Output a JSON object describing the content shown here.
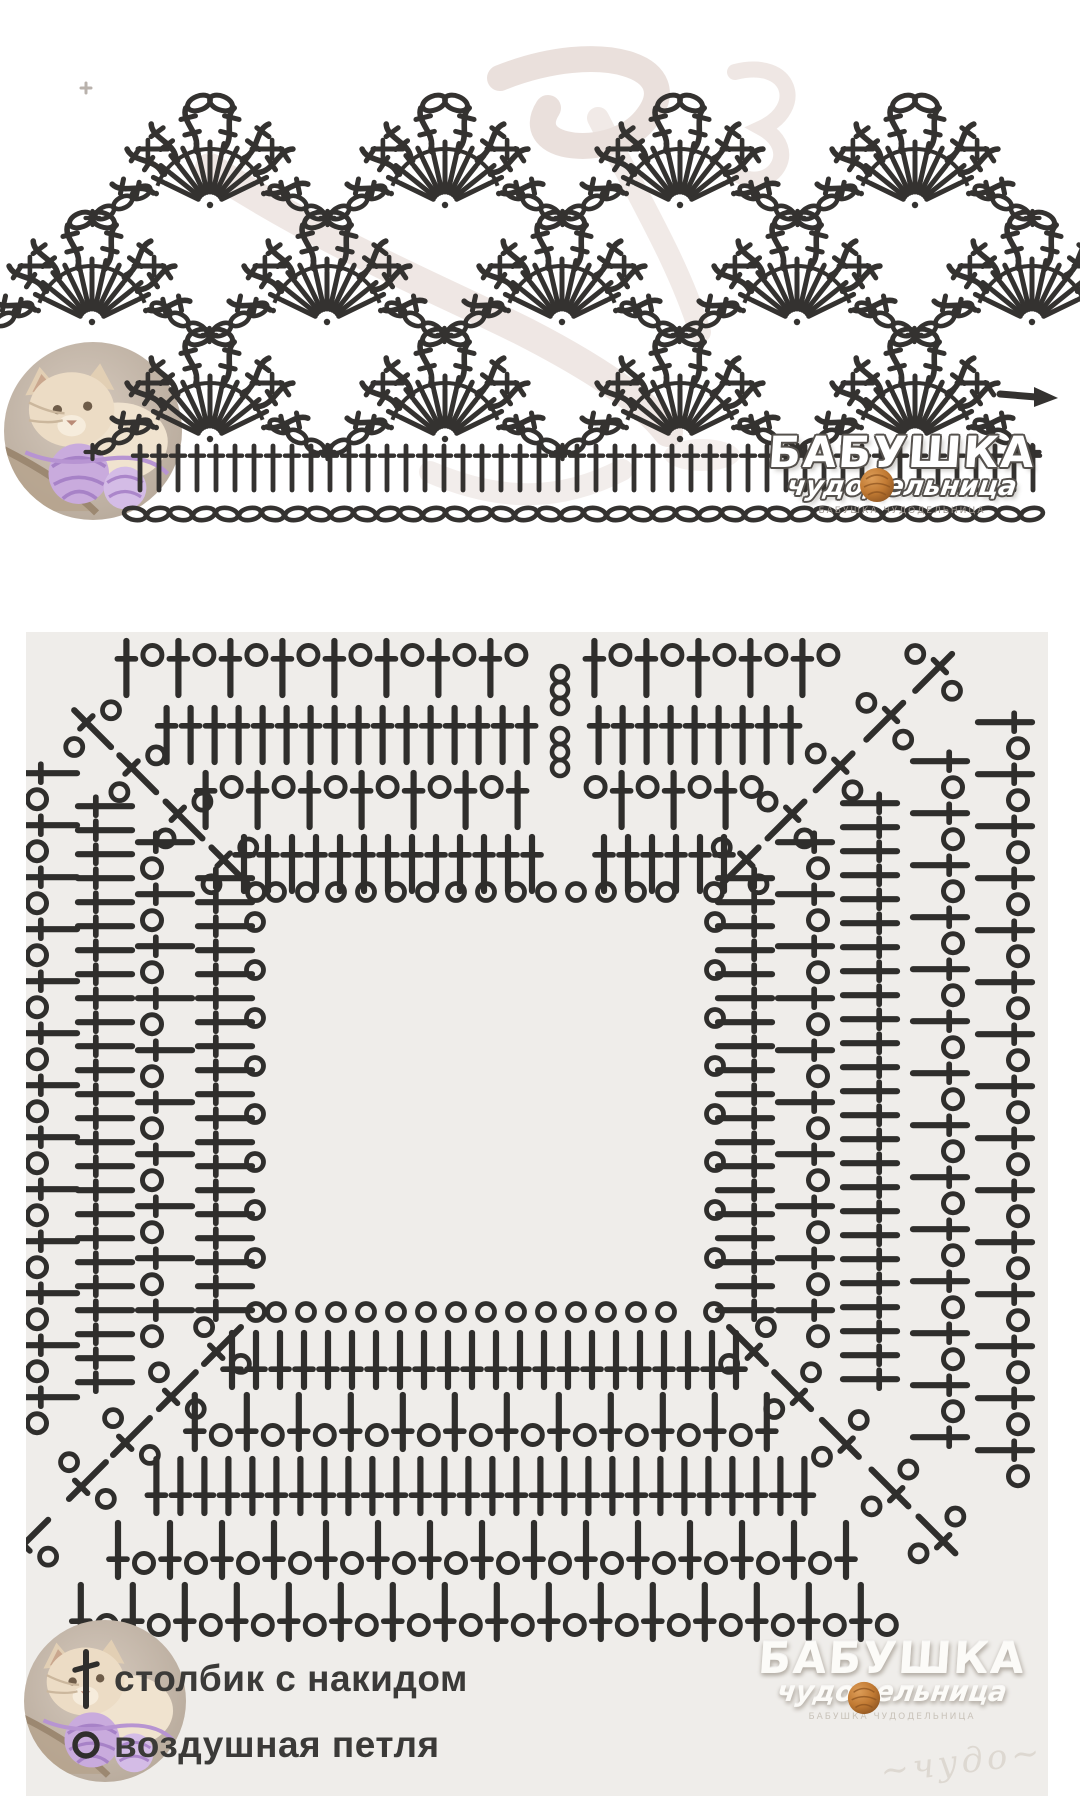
{
  "colors": {
    "page_bg": "#ffffff",
    "panel_bg": "#efedea",
    "symbol": "#2f2e2c",
    "symbol_top": "#343230",
    "watermark_pink": "#d9c8c1",
    "logo_outline": "#55514d",
    "logo_fill": "#ffffff",
    "yarn_ball": "#c17a33",
    "legend_text": "#3b3a38"
  },
  "branding": {
    "logo_line1": "БАБУШКА",
    "logo_line2": "чудодельница",
    "logo_caption": "БАБУШКА ЧУДОДЕЛЬНИЦА"
  },
  "legend": {
    "items": [
      {
        "symbol": "double-crochet-icon",
        "label": "столбик с накидом"
      },
      {
        "symbol": "chain-stitch-icon",
        "label": "воздушная петля"
      }
    ]
  },
  "top_diagram": {
    "rows": [
      {
        "base_y": 205,
        "fan_x": [
          210,
          445,
          680,
          915
        ]
      },
      {
        "base_y": 322,
        "fan_x": [
          92,
          327,
          562,
          797,
          1032
        ]
      },
      {
        "base_y": 439,
        "fan_x": [
          210,
          445,
          680,
          915
        ]
      }
    ],
    "fan": {
      "radius": 55,
      "spokes": 11
    },
    "cluster": {
      "arm_angles": [
        -78,
        -56,
        -36,
        -14,
        14,
        36,
        56,
        78
      ],
      "inner_r": 58,
      "outer_r": 100
    },
    "foundation": {
      "post_y": 468,
      "post_len": 44,
      "x_start": 140,
      "x_end": 1046,
      "post_step": 19,
      "chain_y": 514,
      "chain_step": 23
    },
    "turn_arrow": {
      "x": 1000,
      "y": 394
    }
  },
  "square_chart": {
    "hole": {
      "x1": 242,
      "y1": 272,
      "x2": 676,
      "y2": 668
    },
    "inner_ring": {
      "top_step": 30,
      "side_step": 48
    },
    "bands": {
      "top": {
        "rounds": [
          {
            "off": 40,
            "type": "cont"
          },
          {
            "off": 104,
            "type": "alt"
          },
          {
            "off": 169,
            "type": "cont"
          },
          {
            "off": 236,
            "type": "alt"
          }
        ]
      },
      "left": {
        "rounds": [
          {
            "off": 43,
            "type": "cont"
          },
          {
            "off": 103,
            "type": "alt"
          },
          {
            "off": 163,
            "type": "cont"
          },
          {
            "off": 218,
            "type": "alt"
          }
        ]
      },
      "right": {
        "rounds": [
          {
            "off": 43,
            "type": "cont"
          },
          {
            "off": 103,
            "type": "alt"
          },
          {
            "off": 168,
            "type": "cont"
          },
          {
            "off": 238,
            "type": "alt"
          },
          {
            "off": 303,
            "type": "alt"
          }
        ]
      },
      "bottom": {
        "rounds": [
          {
            "off": 60,
            "type": "cont"
          },
          {
            "off": 122,
            "type": "alt"
          },
          {
            "off": 186,
            "type": "cont"
          },
          {
            "off": 250,
            "type": "alt"
          },
          {
            "off": 312,
            "type": "alt"
          }
        ]
      }
    },
    "turning_chains": [
      {
        "x": 534,
        "y": 42
      },
      {
        "x": 534,
        "y": 104
      }
    ]
  }
}
